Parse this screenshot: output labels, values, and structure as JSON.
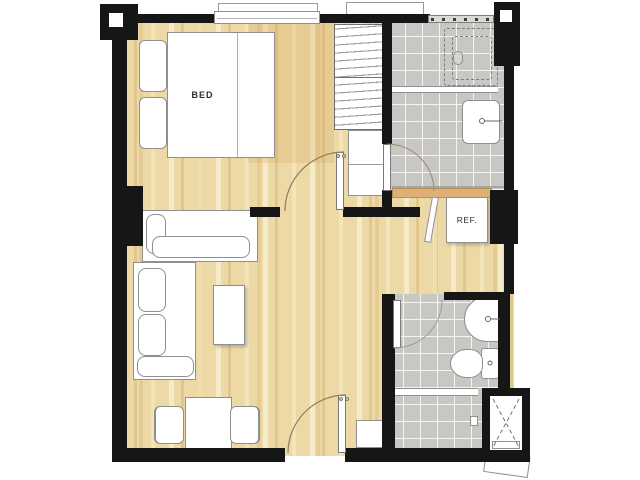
{
  "title": "One-bedroom condominium unit floor plan",
  "labels": {
    "bed": "BED",
    "refrigerator": "REF."
  },
  "colors": {
    "wall": "#161616",
    "wood_floor": "#ecd9a6",
    "wood_grain": "#d5a55c",
    "tile_floor": "#c8c7c3",
    "grout": "#ffffff",
    "furniture_fill": "#ffffff",
    "furniture_outline": "#8f8f8f",
    "kitchen_counter": "#deb077",
    "door_arc": "#8f7f60",
    "background": "#ffffff"
  },
  "fixtures": [
    "double-bed",
    "pillows",
    "bedroom-window",
    "wardrobe",
    "storage-cabinet",
    "corner-sofa",
    "coffee-table",
    "dining-table",
    "dining-chairs",
    "refrigerator",
    "kitchen-counter",
    "shower-enclosure",
    "vanity-sink",
    "washbasin",
    "toilet",
    "shower-partition",
    "bathroom-window",
    "service-shaft",
    "entrance-door",
    "bedroom-door",
    "bathroom-doors",
    "structural-columns",
    "ac-ledge",
    "entry-cabinet"
  ]
}
